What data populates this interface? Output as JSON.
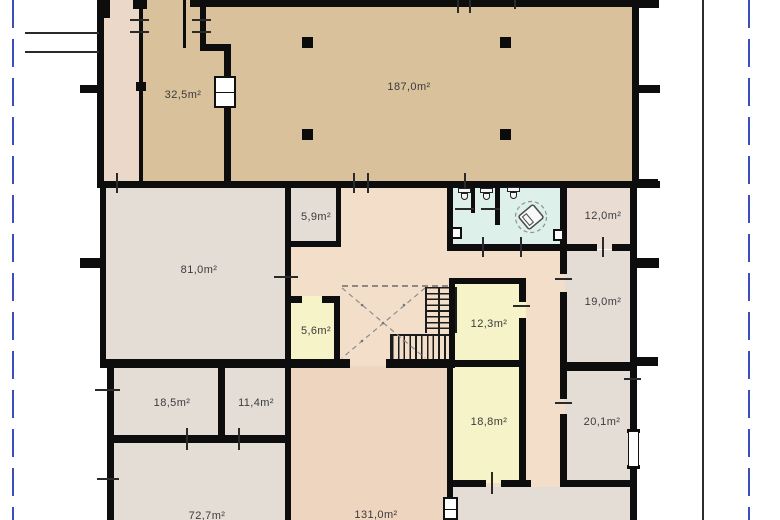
{
  "plan": {
    "type": "architectural-floor-plan",
    "rooms": {
      "r32_5": {
        "area": "32,5m²"
      },
      "r187_0": {
        "area": "187,0m²"
      },
      "r5_9": {
        "area": "5,9m²"
      },
      "r12_0": {
        "area": "12,0m²"
      },
      "r81_0": {
        "area": "81,0m²"
      },
      "r19_0": {
        "area": "19,0m²"
      },
      "r5_6": {
        "area": "5,6m²"
      },
      "r12_3": {
        "area": "12,3m²"
      },
      "r18_5": {
        "area": "18,5m²"
      },
      "r11_4": {
        "area": "11,4m²"
      },
      "r18_8": {
        "area": "18,8m²"
      },
      "r20_1": {
        "area": "20,1m²"
      },
      "r72_7": {
        "area": "72,7m²"
      },
      "r131_0": {
        "area": "131,0m²"
      }
    },
    "icons": {
      "toilet": "toilet-icon",
      "sink": "sink-icon",
      "turning_circle": "accessible-turning-circle-icon",
      "stairs": "staircase-icon",
      "column": "column-marker",
      "window": "window-icon",
      "door": "door-leaf-icon"
    }
  },
  "colors": {
    "wall": "#0d0d0d",
    "tan": "#d8c19b",
    "pinkStrip": "#ecd8c9",
    "hall": "#f3deca",
    "pink131": "#eed5bf",
    "gray": "#e4ddd6",
    "gray2": "#e8dcd3",
    "yellow": "#f6f3c8",
    "cyan": "#def0ea",
    "label": "#3b3b3b",
    "boundary": "#3c4ebc"
  }
}
